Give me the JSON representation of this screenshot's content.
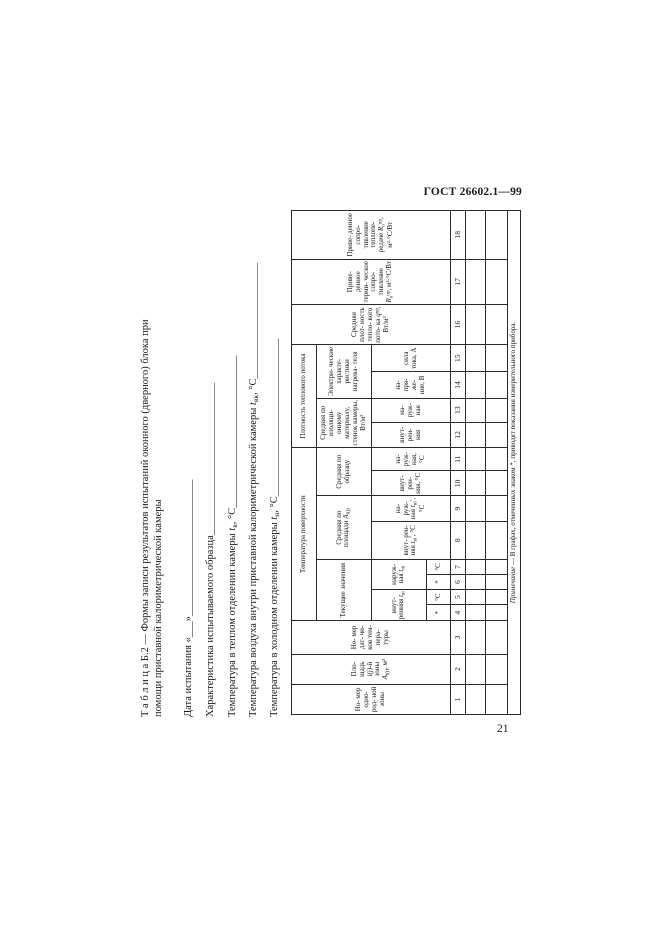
{
  "colors": {
    "background": "#ffffff",
    "text": "#1b1b1b",
    "table_border": "#2a2a2a"
  },
  "page": {
    "header_right": "ГОСТ 26602.1—99",
    "page_number": "21"
  },
  "title": {
    "line1": "Т а б л и ц а  Б.2 — Формы записи результатов испытаний оконного (дверного) блока при",
    "line2": "помощи приставной калориметрической камеры"
  },
  "form_lines": {
    "date": [
      {
        "t": "Дата испытания «___»__________________________"
      }
    ],
    "characteristic": [
      {
        "t": "Характеристика испытываемого образца_____________________________"
      }
    ],
    "warm": [
      {
        "t": "Температура в теплом отделении камеры "
      },
      {
        "t": "t",
        "m": "i"
      },
      {
        "t": "в",
        "m": "sub"
      },
      {
        "t": ", °С_____________________________"
      }
    ],
    "inner": [
      {
        "t": "Температура воздуха внутри приставной калориметрической камеры "
      },
      {
        "t": "t",
        "m": "i"
      },
      {
        "t": "вк",
        "m": "sub"
      },
      {
        "t": ", °С______________________"
      }
    ],
    "cold": [
      {
        "t": "Температура в холодном отделении камеры "
      },
      {
        "t": "t",
        "m": "i"
      },
      {
        "t": "н",
        "m": "sub"
      },
      {
        "t": ", °С______________________________"
      }
    ]
  },
  "table": {
    "cells": {
      "c1": [
        {
          "t": "Но- мер одно- род- ной зоны"
        }
      ],
      "c2": [
        {
          "t": "Пло- щадь "
        },
        {
          "t": "i(j)",
          "m": "i"
        },
        {
          "t": "-й зоны "
        },
        {
          "t": "A",
          "m": "i"
        },
        {
          "t": "i(j)",
          "m": "sub"
        },
        {
          "t": ", м²"
        }
      ],
      "c3": [
        {
          "t": "Но- мер дат- чи- ков тем- пера- туры"
        }
      ],
      "gA1": [
        {
          "t": "Температура поверхности"
        }
      ],
      "gA2": [
        {
          "t": "Плотность теплового потока"
        }
      ],
      "gB1": [
        {
          "t": "Текущие значения"
        }
      ],
      "gB2": [
        {
          "t": "Средняя по площади "
        },
        {
          "t": "A",
          "m": "i"
        },
        {
          "t": "i(j)",
          "m": "sub"
        }
      ],
      "gB3": [
        {
          "t": "Средняя по образцу"
        }
      ],
      "gB4": [
        {
          "t": "Средняя по изоляци- онному материалу, стенок камеры, Вт/м²"
        }
      ],
      "gB5": [
        {
          "t": "Электри- ческие характе- ристики нагрева- теля"
        }
      ],
      "gC45": [
        {
          "t": "внут- ренняя "
        },
        {
          "t": "t",
          "m": "i"
        },
        {
          "t": "вi",
          "m": "sub"
        }
      ],
      "gC67": [
        {
          "t": "наруж- ная "
        },
        {
          "t": "t",
          "m": "i"
        },
        {
          "t": "нi",
          "m": "sub"
        }
      ],
      "c8": [
        {
          "t": "внут- рен- няя "
        },
        {
          "t": "t",
          "m": "i"
        },
        {
          "t": "вi",
          "m": "sub"
        },
        {
          "t": "′, °С"
        }
      ],
      "c9": [
        {
          "t": "на- руж- ная "
        },
        {
          "t": "t",
          "m": "i"
        },
        {
          "t": "нi",
          "m": "sub"
        },
        {
          "t": "′, °С"
        }
      ],
      "c10": [
        {
          "t": "внут- рен- няя, °С"
        }
      ],
      "c11": [
        {
          "t": "на- руж- ная, °С"
        }
      ],
      "c12": [
        {
          "t": "внут- рен- няя"
        }
      ],
      "c13": [
        {
          "t": "на- руж- ная"
        }
      ],
      "c14": [
        {
          "t": "на- пря- же- ние, В"
        }
      ],
      "c15": [
        {
          "t": "сила тока, А"
        }
      ],
      "c16": [
        {
          "t": "Средняя плот- ность тепло- вого пото- ка "
        },
        {
          "t": "q",
          "m": "i"
        },
        {
          "t": "пр",
          "m": "sup"
        },
        {
          "t": ", Вт/м²"
        }
      ],
      "c17": [
        {
          "t": "Приве- денное терми- ческое сопро- тивление "
        },
        {
          "t": "R",
          "m": "i"
        },
        {
          "t": "к",
          "m": "sub"
        },
        {
          "t": "пр",
          "m": "sup"
        },
        {
          "t": ", м²·°С/Вт"
        }
      ],
      "c18": [
        {
          "t": "Приве- денное сопро- тивление теплопе- редаче "
        },
        {
          "t": "R",
          "m": "i"
        },
        {
          "t": "о",
          "m": "sub"
        },
        {
          "t": "пр",
          "m": "sup"
        },
        {
          "t": ", м²·°С/Вт"
        }
      ],
      "d4": "*",
      "d5": "°С",
      "d6": "*",
      "d7": "°С"
    },
    "col_numbers": [
      "1",
      "2",
      "3",
      "4",
      "5",
      "6",
      "7",
      "8",
      "9",
      "10",
      "11",
      "12",
      "13",
      "14",
      "15",
      "16",
      "17",
      "18"
    ],
    "footnote": [
      {
        "t": "Примечание",
        "m": "i"
      },
      {
        "t": " — В графах, отмеченных знаком *, приводят показания измерительного прибора."
      }
    ]
  }
}
